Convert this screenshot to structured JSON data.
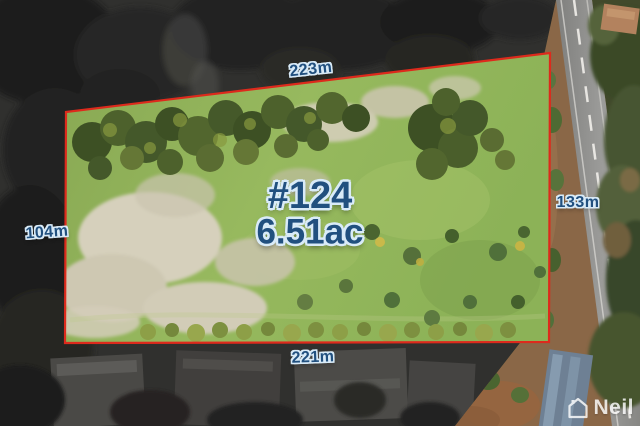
{
  "overlay": {
    "lot_number": "#124",
    "lot_size": "6.51ac",
    "dimension_top": "223m",
    "dimension_bottom": "221m",
    "dimension_left": "104m",
    "dimension_right": "133m"
  },
  "watermark": {
    "text": "Neil",
    "icon": "house-o-icon"
  },
  "colors": {
    "boundary": "#dd2a1c",
    "label_fill": "#21507f",
    "label_outline": "#d9ebf8",
    "watermark": "#ffffff"
  }
}
